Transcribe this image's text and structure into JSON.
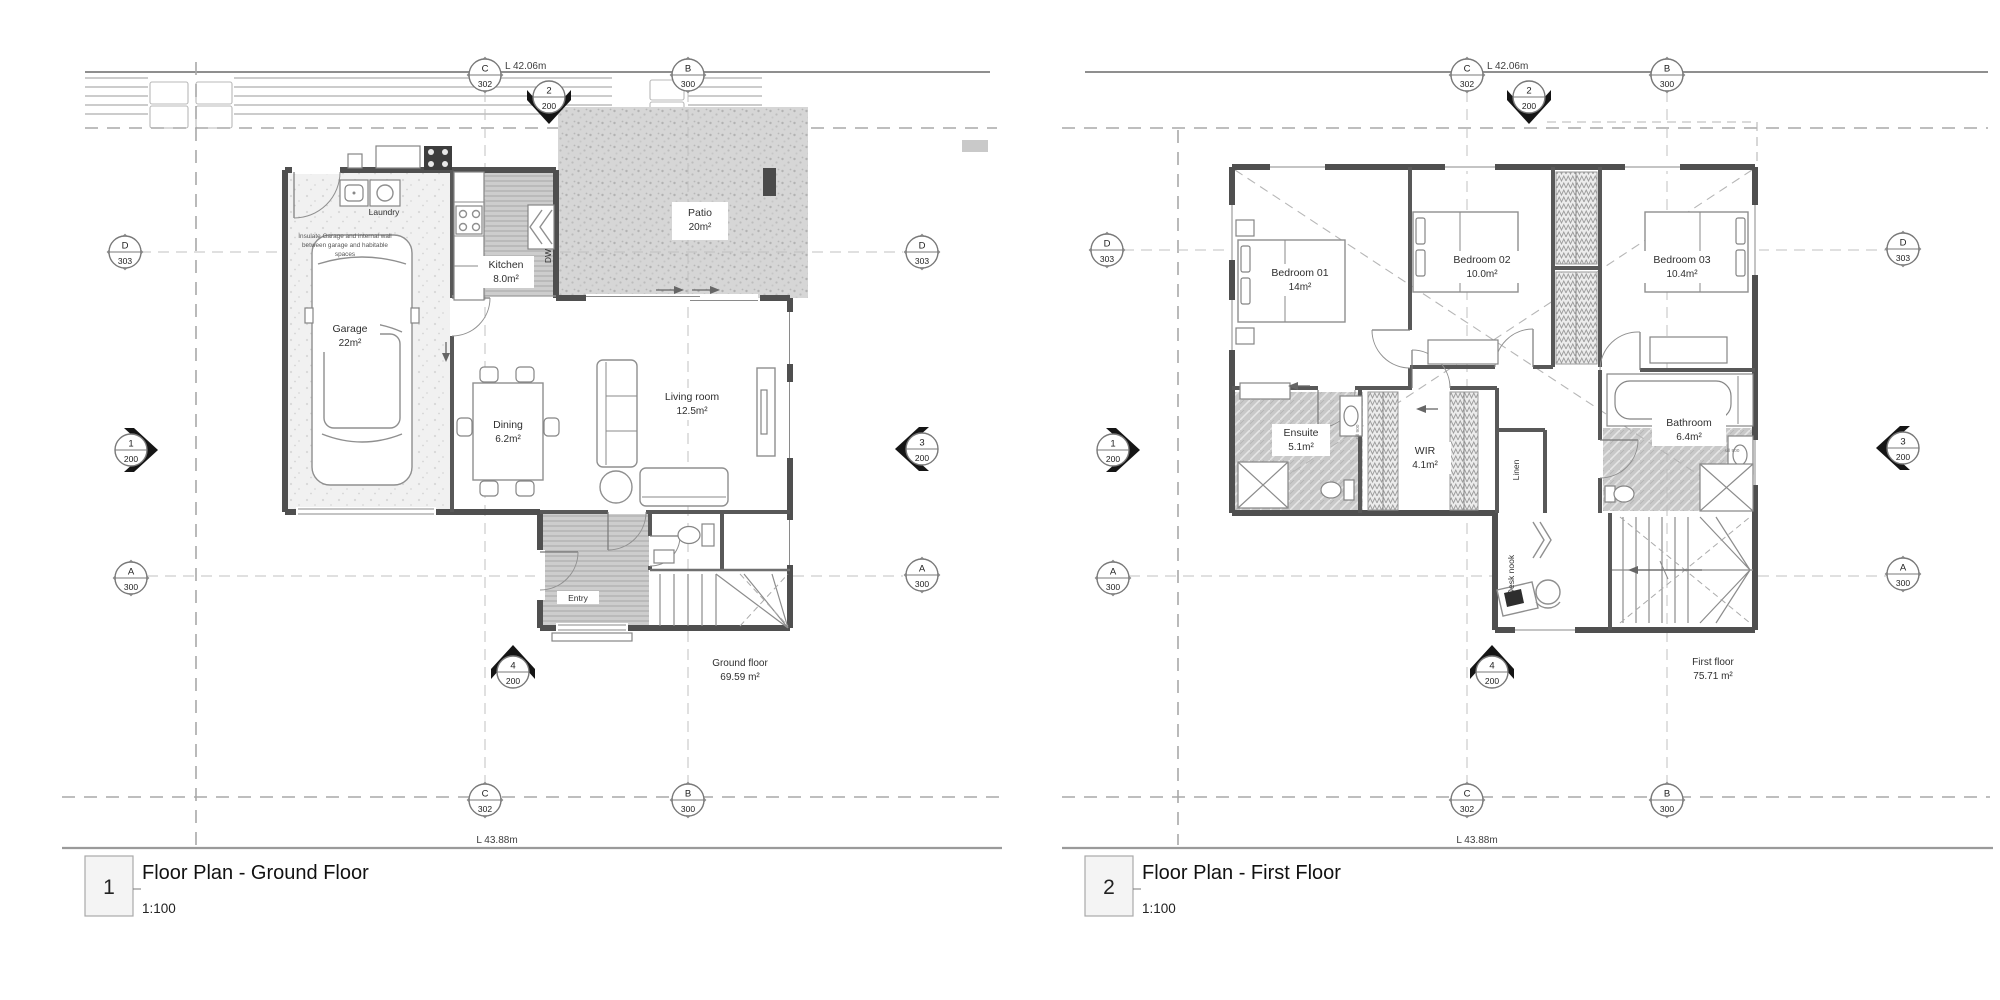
{
  "markers": {
    "c": {
      "t": "C",
      "b": "302"
    },
    "b": {
      "t": "B",
      "b": "300"
    },
    "d": {
      "t": "D",
      "b": "303"
    },
    "a": {
      "t": "A",
      "b": "300"
    },
    "s1": {
      "t": "1",
      "b": "200"
    },
    "s2": {
      "t": "2",
      "b": "200"
    },
    "s3": {
      "t": "3",
      "b": "200"
    },
    "s4": {
      "t": "4",
      "b": "200"
    }
  },
  "dims": {
    "top": "L 42.06m",
    "bottom": "L 43.88m"
  },
  "ground": {
    "num": "1",
    "title": "Floor Plan - Ground Floor",
    "scale": "1:100",
    "garage_name": "Garage",
    "garage_area": "22m²",
    "kitchen_name": "Kitchen",
    "kitchen_area": "8.0m²",
    "laundry": "Laundry",
    "dw": "DW",
    "dining_name": "Dining",
    "dining_area": "6.2m²",
    "living_name": "Living room",
    "living_area": "12.5m²",
    "patio_name": "Patio",
    "patio_area": "20m²",
    "entry": "Entry",
    "note1": "Insulate Garage and internal wall",
    "note2": "between garage and habitable",
    "note3": "spaces",
    "sum_name": "Ground floor",
    "sum_area": "69.59 m²"
  },
  "first": {
    "num": "2",
    "title": "Floor Plan - First Floor",
    "scale": "1:100",
    "b1_name": "Bedroom 01",
    "b1_area": "14m²",
    "b2_name": "Bedroom 02",
    "b2_area": "10.0m²",
    "b3_name": "Bedroom 03",
    "b3_area": "10.4m²",
    "ens_name": "Ensuite",
    "ens_area": "5.1m²",
    "wir_name": "WIR",
    "wir_area": "4.1m²",
    "bath_name": "Bathroom",
    "bath_area": "6.4m²",
    "linen": "Linen",
    "desk": "Desk nook",
    "sill": "sill 900",
    "sum_name": "First floor",
    "sum_area": "75.71 m²"
  }
}
